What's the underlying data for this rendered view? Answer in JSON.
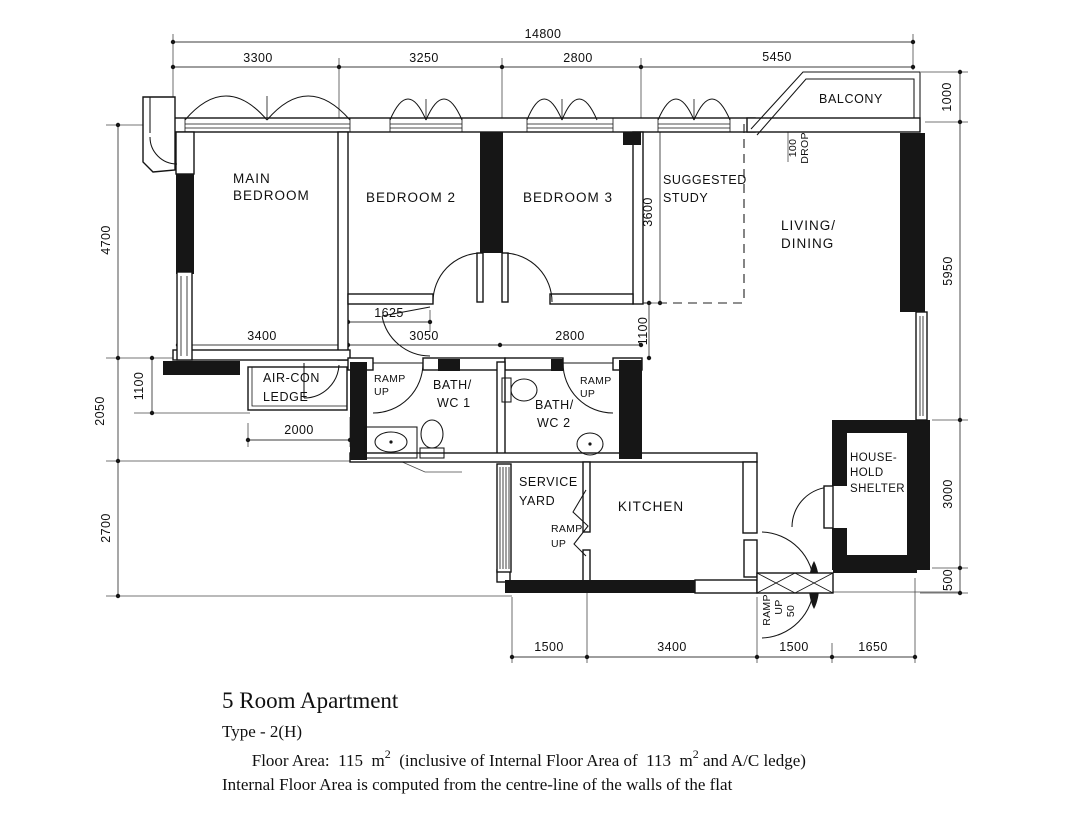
{
  "rooms": {
    "main_bedroom": [
      "MAIN",
      "BEDROOM"
    ],
    "bedroom2": "BEDROOM 2",
    "bedroom3": "BEDROOM 3",
    "suggested_study": [
      "SUGGESTED",
      "STUDY"
    ],
    "living_dining": [
      "LIVING/",
      "DINING"
    ],
    "balcony": "BALCONY",
    "aircon_ledge": [
      "AIR-CON",
      "LEDGE"
    ],
    "bath_wc1": [
      "BATH/",
      "WC 1"
    ],
    "bath_wc2": [
      "BATH/",
      "WC 2"
    ],
    "service_yard": [
      "SERVICE",
      "YARD"
    ],
    "kitchen": "KITCHEN",
    "household_shelter": [
      "HOUSE-",
      "HOLD",
      "SHELTER"
    ]
  },
  "dimensions": {
    "overall_width": "14800",
    "top": [
      "3300",
      "3250",
      "2800",
      "5450"
    ],
    "left": {
      "bedroom_depth": "4700",
      "ledge_zone": "2050",
      "ledge_offset": "1100",
      "lower_zone": "2700"
    },
    "right": {
      "balcony_depth": "1000",
      "living_length": "5950",
      "shelter_zone": "3000",
      "step": "500"
    },
    "bottom": [
      "1500",
      "3400",
      "1500",
      "1650"
    ],
    "internal": {
      "main_bedroom_width": "3400",
      "hall_opening": "1625",
      "bedroom2_width": "3050",
      "bedroom3_width": "2800",
      "hall_depth": "1100",
      "study_depth": "3600",
      "ledge_width": "2000",
      "balcony_drop": [
        "100",
        "DROP"
      ]
    }
  },
  "annotations": {
    "ramp_bath1": [
      "RAMP",
      "UP"
    ],
    "ramp_bath2": [
      "RAMP",
      "UP"
    ],
    "ramp_service": [
      "RAMP",
      "UP"
    ],
    "ramp_entrance": [
      "RAMP",
      "UP",
      "50"
    ]
  },
  "title_block": {
    "title": "5 Room Apartment",
    "type": "Type - 2(H)",
    "floor_area_prefix": "Floor Area:  115  m",
    "floor_area_sup1": "2",
    "floor_area_middle": "  (inclusive of Internal Floor Area of  113  m",
    "floor_area_sup2": "2",
    "floor_area_suffix": " and A/C ledge)",
    "note": "Internal Floor Area is computed from the centre-line of the walls of the flat"
  }
}
